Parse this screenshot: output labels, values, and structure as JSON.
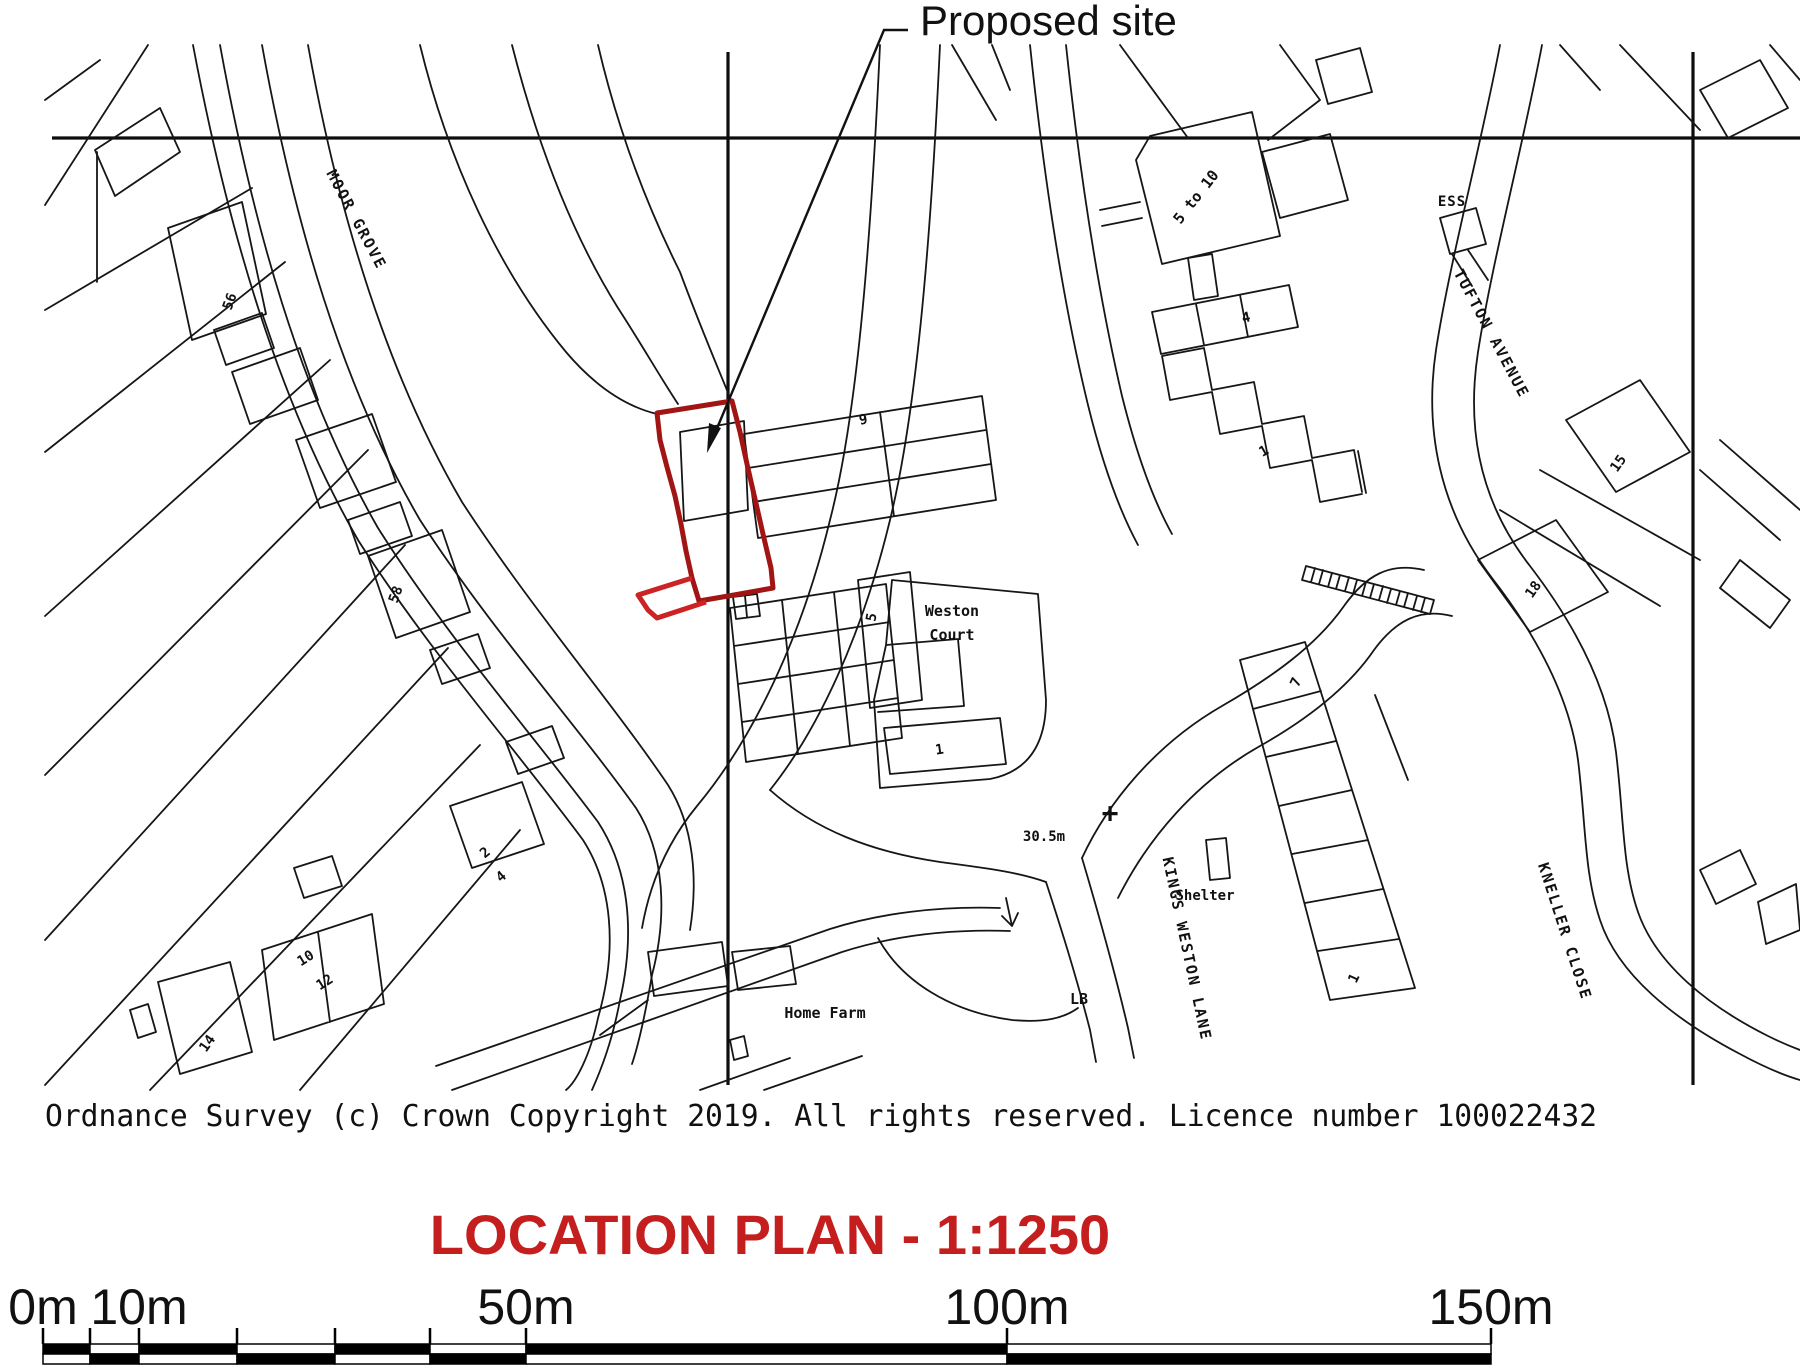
{
  "map": {
    "proposed_site": {
      "label": "Proposed site",
      "outline_color": "#a11515",
      "spur_color": "#cc2424"
    },
    "labels": [
      {
        "name": "proposed-site",
        "text": "Proposed site",
        "x": 920,
        "y": 35,
        "rot": 0,
        "size": 42,
        "font": "sans",
        "anchor": "start"
      },
      {
        "name": "street-moor-grove",
        "text": "MOOR GROVE",
        "x": 352,
        "y": 222,
        "rot": 62,
        "size": 15,
        "ls": 2
      },
      {
        "name": "house-56",
        "text": "56",
        "x": 234,
        "y": 303,
        "rot": -70,
        "size": 14
      },
      {
        "name": "house-58",
        "text": "58",
        "x": 400,
        "y": 596,
        "rot": -70,
        "size": 14
      },
      {
        "name": "house-2",
        "text": "2",
        "x": 488,
        "y": 856,
        "rot": -40,
        "size": 14
      },
      {
        "name": "house-4-left",
        "text": "4",
        "x": 504,
        "y": 880,
        "rot": -40,
        "size": 14
      },
      {
        "name": "house-10",
        "text": "10",
        "x": 308,
        "y": 962,
        "rot": -32,
        "size": 14
      },
      {
        "name": "house-12",
        "text": "12",
        "x": 327,
        "y": 986,
        "rot": -32,
        "size": 14
      },
      {
        "name": "house-14",
        "text": "14",
        "x": 211,
        "y": 1046,
        "rot": -55,
        "size": 14
      },
      {
        "name": "house-9",
        "text": "9",
        "x": 864,
        "y": 424,
        "rot": -10,
        "size": 14
      },
      {
        "name": "house-5-weston",
        "text": "5",
        "x": 876,
        "y": 618,
        "rot": -80,
        "size": 14
      },
      {
        "name": "weston-court-1",
        "text": "Weston",
        "x": 952,
        "y": 616,
        "rot": 0,
        "size": 15
      },
      {
        "name": "weston-court-2",
        "text": "Court",
        "x": 952,
        "y": 640,
        "rot": 0,
        "size": 15
      },
      {
        "name": "house-1-weston",
        "text": "1",
        "x": 940,
        "y": 754,
        "rot": -8,
        "size": 14
      },
      {
        "name": "house-5-to-10",
        "text": "5 to 10",
        "x": 1200,
        "y": 200,
        "rot": -52,
        "size": 15
      },
      {
        "name": "house-4-terrace",
        "text": "4",
        "x": 1247,
        "y": 322,
        "rot": -12,
        "size": 14
      },
      {
        "name": "house-1-terrace",
        "text": "1",
        "x": 1266,
        "y": 455,
        "rot": -30,
        "size": 14
      },
      {
        "name": "ess-substation",
        "text": "ESS",
        "x": 1452,
        "y": 206,
        "rot": 0,
        "size": 14,
        "ls": 1
      },
      {
        "name": "street-tufton-avenue",
        "text": "TUFTON AVENUE",
        "x": 1487,
        "y": 336,
        "rot": 62,
        "size": 15,
        "ls": 2
      },
      {
        "name": "house-15",
        "text": "15",
        "x": 1622,
        "y": 466,
        "rot": -55,
        "size": 14
      },
      {
        "name": "house-18",
        "text": "18",
        "x": 1537,
        "y": 592,
        "rot": -55,
        "size": 14
      },
      {
        "name": "house-7",
        "text": "7",
        "x": 1300,
        "y": 684,
        "rot": -65,
        "size": 14
      },
      {
        "name": "house-1-kwl",
        "text": "1",
        "x": 1358,
        "y": 980,
        "rot": -65,
        "size": 14
      },
      {
        "name": "street-kneller-close",
        "text": "KNELLER CLOSE",
        "x": 1560,
        "y": 933,
        "rot": 72,
        "size": 15,
        "ls": 2
      },
      {
        "name": "street-kings-weston-lane",
        "text": "KINGS WESTON LANE",
        "x": 1182,
        "y": 950,
        "rot": 78,
        "size": 15,
        "ls": 2
      },
      {
        "name": "spot-height",
        "text": "30.5m",
        "x": 1044,
        "y": 841,
        "rot": 0,
        "size": 14
      },
      {
        "name": "benchmark-cross",
        "text": "+",
        "x": 1110,
        "y": 822,
        "rot": 0,
        "size": 28
      },
      {
        "name": "shelter",
        "text": "Shelter",
        "x": 1205,
        "y": 900,
        "rot": 0,
        "size": 14
      },
      {
        "name": "lb-letterbox",
        "text": "LB",
        "x": 1079,
        "y": 1004,
        "rot": 0,
        "size": 15
      },
      {
        "name": "home-farm",
        "text": "Home Farm",
        "x": 825,
        "y": 1018,
        "rot": 0,
        "size": 15
      }
    ]
  },
  "copyright": "Ordnance Survey (c) Crown Copyright 2019. All rights reserved. Licence number 100022432",
  "title": {
    "text": "LOCATION PLAN - 1:1250",
    "color": "#c41e1e"
  },
  "scale_bar": {
    "labels": [
      {
        "text": "0m",
        "x": 43
      },
      {
        "text": "10m",
        "x": 139
      },
      {
        "text": "50m",
        "x": 526
      },
      {
        "text": "100m",
        "x": 1007
      },
      {
        "text": "150m",
        "x": 1491
      }
    ],
    "boundaries": [
      43,
      90,
      139,
      237,
      335,
      430,
      526,
      1007,
      1491
    ],
    "bar_color": "#000000"
  }
}
